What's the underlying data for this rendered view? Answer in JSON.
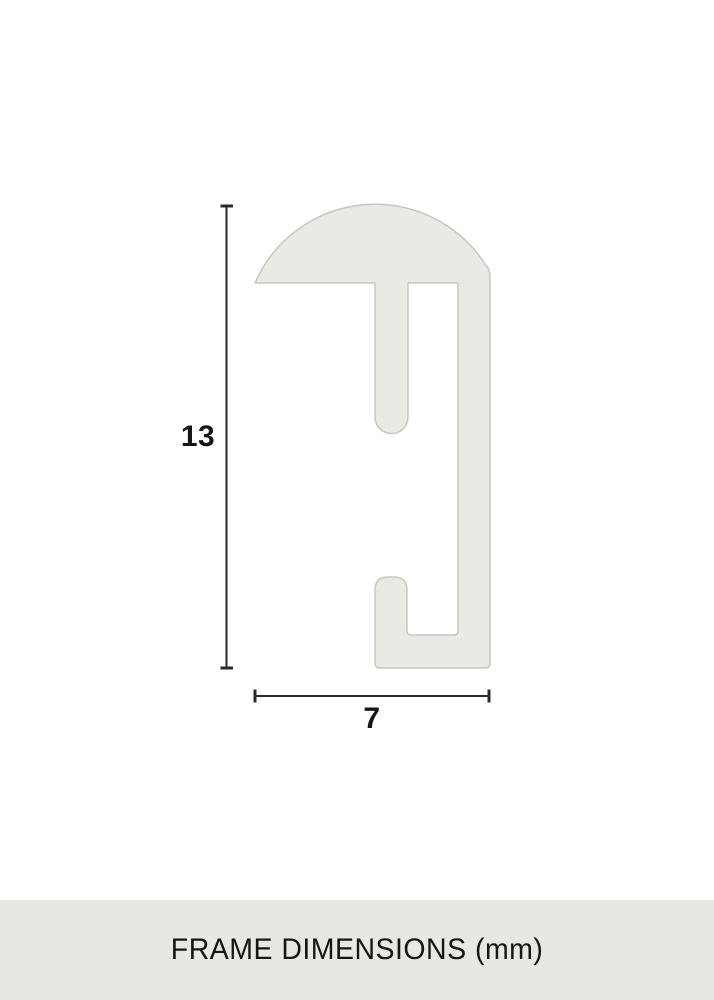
{
  "diagram": {
    "dimensions": {
      "height_value": "13",
      "width_value": "7"
    }
  },
  "footer": {
    "label": "FRAME DIMENSIONS (mm)"
  },
  "colors": {
    "profile_fill": "#e9e9e5",
    "profile_stroke": "#c7c7c2",
    "dimension_line": "#2b2b2b",
    "text": "#161614",
    "footer_bg": "#e8e7e2",
    "canvas_bg": "#ffffff"
  }
}
